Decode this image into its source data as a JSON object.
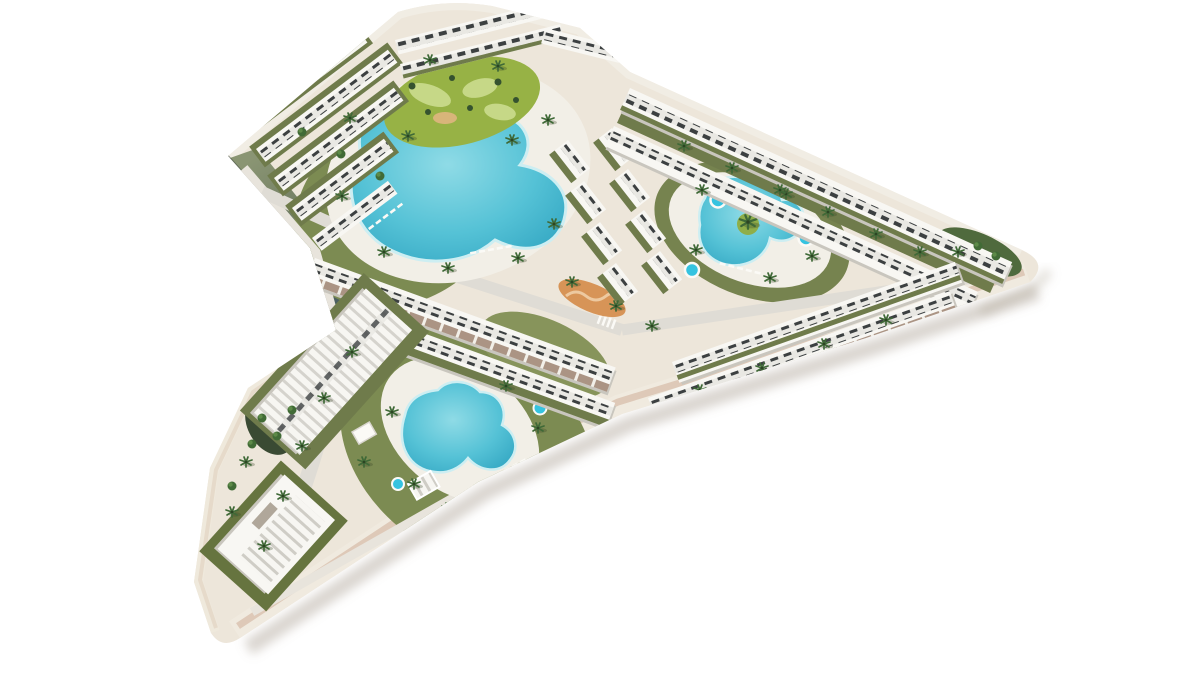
{
  "scene": {
    "title": "Aerial 3D render of a residential resort development",
    "description": "Bird's-eye architectural rendering of a white low-rise apartment complex on a chevron-shaped plot over a plain white background. The plot contains a large lagoon pool with a round landscaped island garden, a heart-shaped pool with a central palm island and round spa whirlpools, a third kidney-shaped pool in the south garden, rows of flat-roofed townhouses with dark glazing strips, olive roof gardens and brown sun terraces, gray internal roads with crosswalks, sun loungers, a pergola clubhouse and scattered palm trees.",
    "background": "#ffffff",
    "palette": {
      "background": "#ffffff",
      "platform": "#ede6da",
      "platform_face": "#f0eadf",
      "platform_edge": "#dbc5b4",
      "edge_green_top": "#8a9573",
      "edge_green_mid": "#64715c",
      "edge_green_bottom": "#3e5763",
      "road": "#dfdcd5",
      "road_light": "#e8e4dc",
      "building": "#f8f7f3",
      "building_shade": "#c9c6be",
      "window_dark": "#3c4041",
      "roof_garden": "#6f7b4b",
      "lawn": "#7c8b52",
      "lawn_dark": "#5a6b3a",
      "shrub": "#35522f",
      "palm": "#3f6937",
      "pool_water": "#55c2d6",
      "pool_water_deep": "#2fa3c0",
      "pool_water_light": "#8fdbe6",
      "spa": "#35c3e0",
      "island": "#97b245",
      "island_light": "#c6d887",
      "terrace": "#ab9484",
      "sand": "#d79457",
      "deck": "#f2efe7"
    },
    "features": {
      "pool_count": 3,
      "spa_count": 5,
      "pools": [
        "lagoon pool with island garden",
        "heart-shaped pool with palm island",
        "kidney pool in south garden"
      ],
      "amenities": [
        "island mini-golf garden",
        "sand playground",
        "sun loungers",
        "spa whirlpools",
        "pergola clubhouse",
        "internal roads with crosswalks"
      ],
      "building_cluster_count": 9,
      "palm_tree_count": 40
    }
  }
}
